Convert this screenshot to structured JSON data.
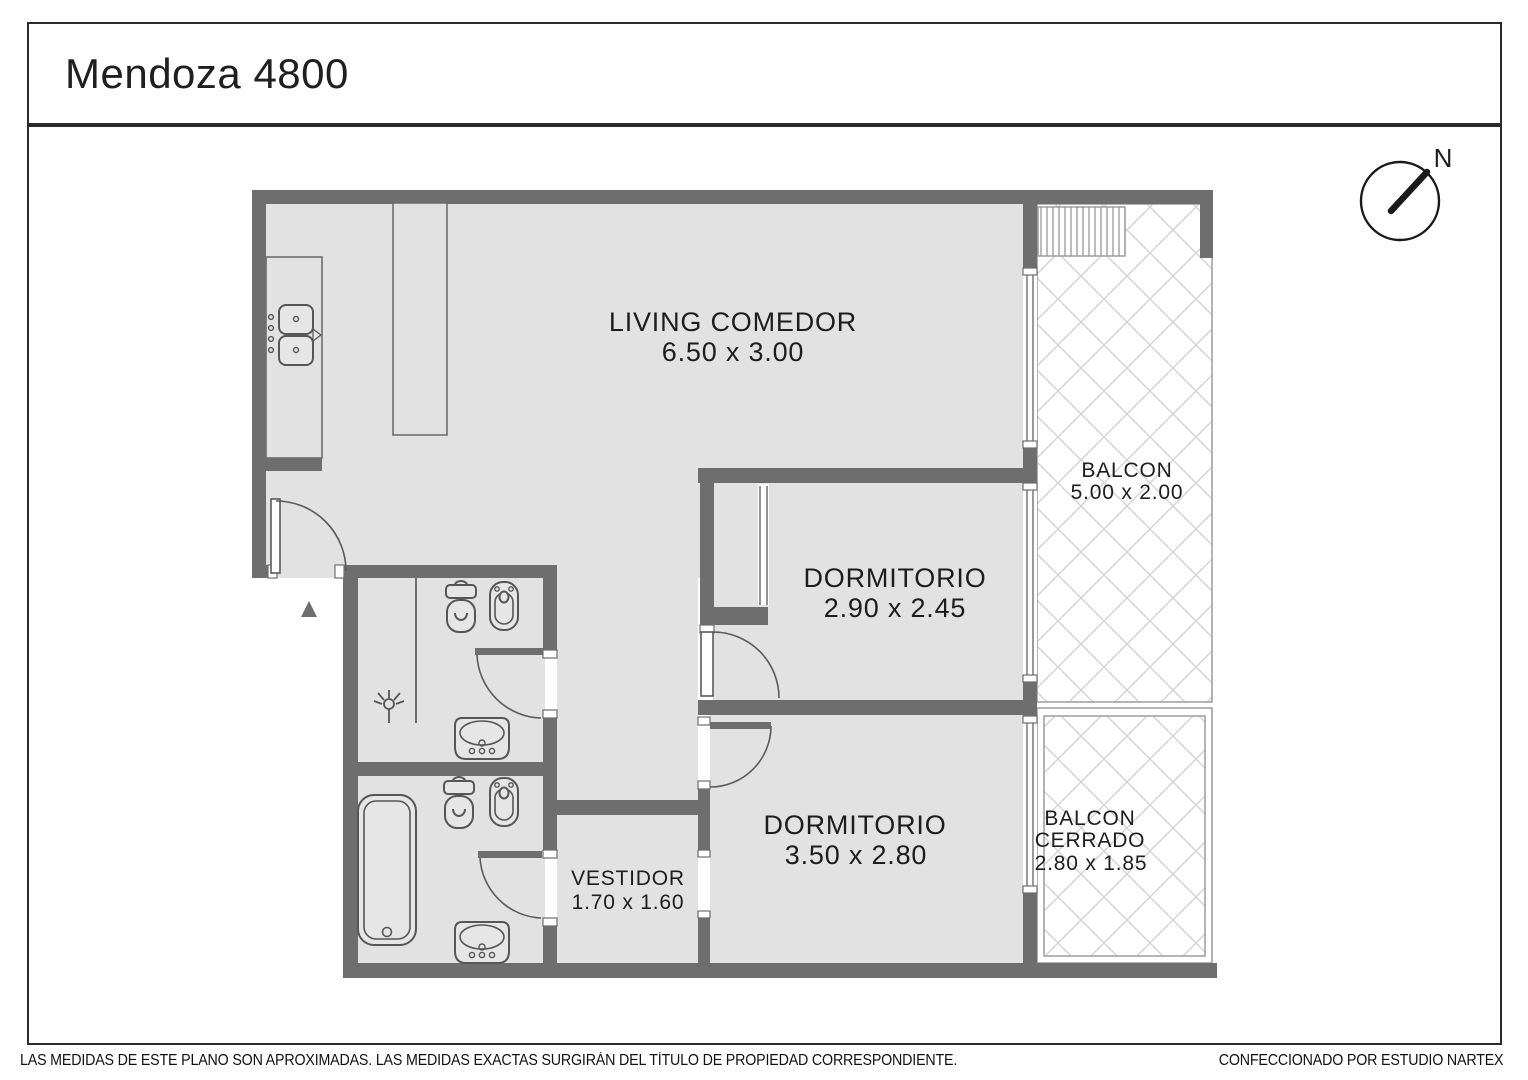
{
  "title": "Mendoza 4800",
  "compass": {
    "label": "N"
  },
  "rooms": {
    "living": {
      "name": "LIVING COMEDOR",
      "dims": "6.50 x 3.00"
    },
    "dormitorio1": {
      "name": "DORMITORIO",
      "dims": "2.90 x 2.45"
    },
    "dormitorio2": {
      "name": "DORMITORIO",
      "dims": "3.50 x 2.80"
    },
    "vestidor": {
      "name": "VESTIDOR",
      "dims": "1.70 x 1.60"
    },
    "balcon": {
      "name": "BALCON",
      "dims": "5.00 x 2.00"
    },
    "balcon_cerrado": {
      "line1": "BALCON",
      "line2": "CERRADO",
      "dims": "2.80 x 1.85"
    }
  },
  "footer": {
    "left": "LAS MEDIDAS  DE ESTE PLANO SON APROXIMADAS. LAS MEDIDAS EXACTAS SURGIRÁN DEL TÍTULO DE PROPIEDAD CORRESPONDIENTE.",
    "right": "CONFECCIONADO POR ESTUDIO NARTEX"
  },
  "colors": {
    "wall": "#6e6e6e",
    "floor": "#e2e2e2",
    "hatch_line": "#d4d4d4",
    "fixture_outline": "#565656",
    "text": "#1d1d1d",
    "border": "#2b2b2b"
  }
}
